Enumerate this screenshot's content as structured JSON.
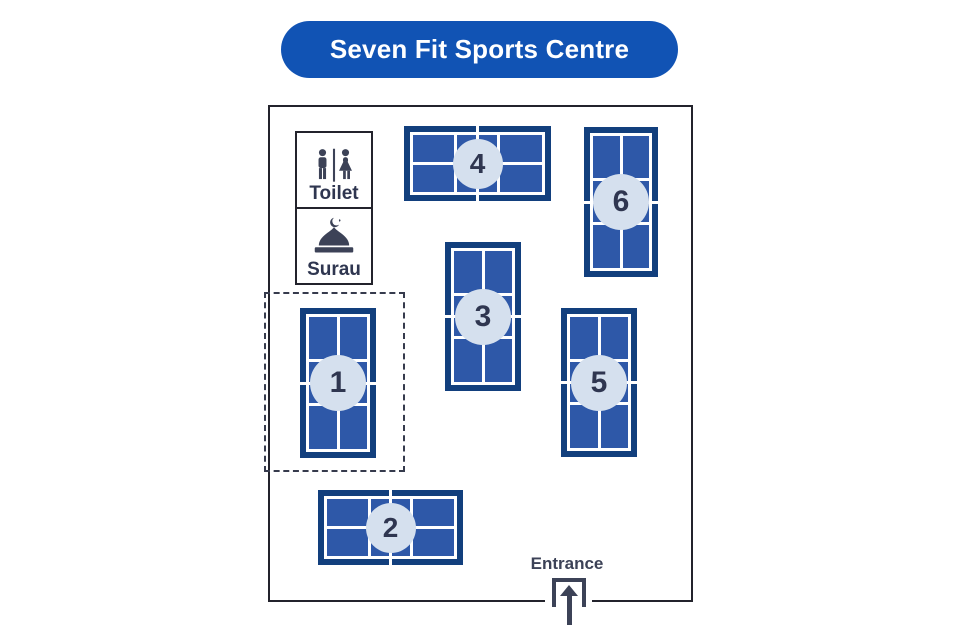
{
  "title": "Seven Fit Sports Centre",
  "facilities": {
    "toilet": {
      "label": "Toilet"
    },
    "surau": {
      "label": "Surau"
    }
  },
  "entrance": {
    "label": "Entrance"
  },
  "courts": [
    {
      "number": "1"
    },
    {
      "number": "2"
    },
    {
      "number": "3"
    },
    {
      "number": "4"
    },
    {
      "number": "5"
    },
    {
      "number": "6"
    }
  ],
  "colors": {
    "accent_blue": "#1153b4",
    "court_border": "#123f7d",
    "court_fill": "#2e58a8",
    "court_line": "#ffffff",
    "badge_fill": "#d5e0ee",
    "text_dark": "#2f3650",
    "icon_dark": "#3c4257",
    "wall": "#23232c"
  }
}
